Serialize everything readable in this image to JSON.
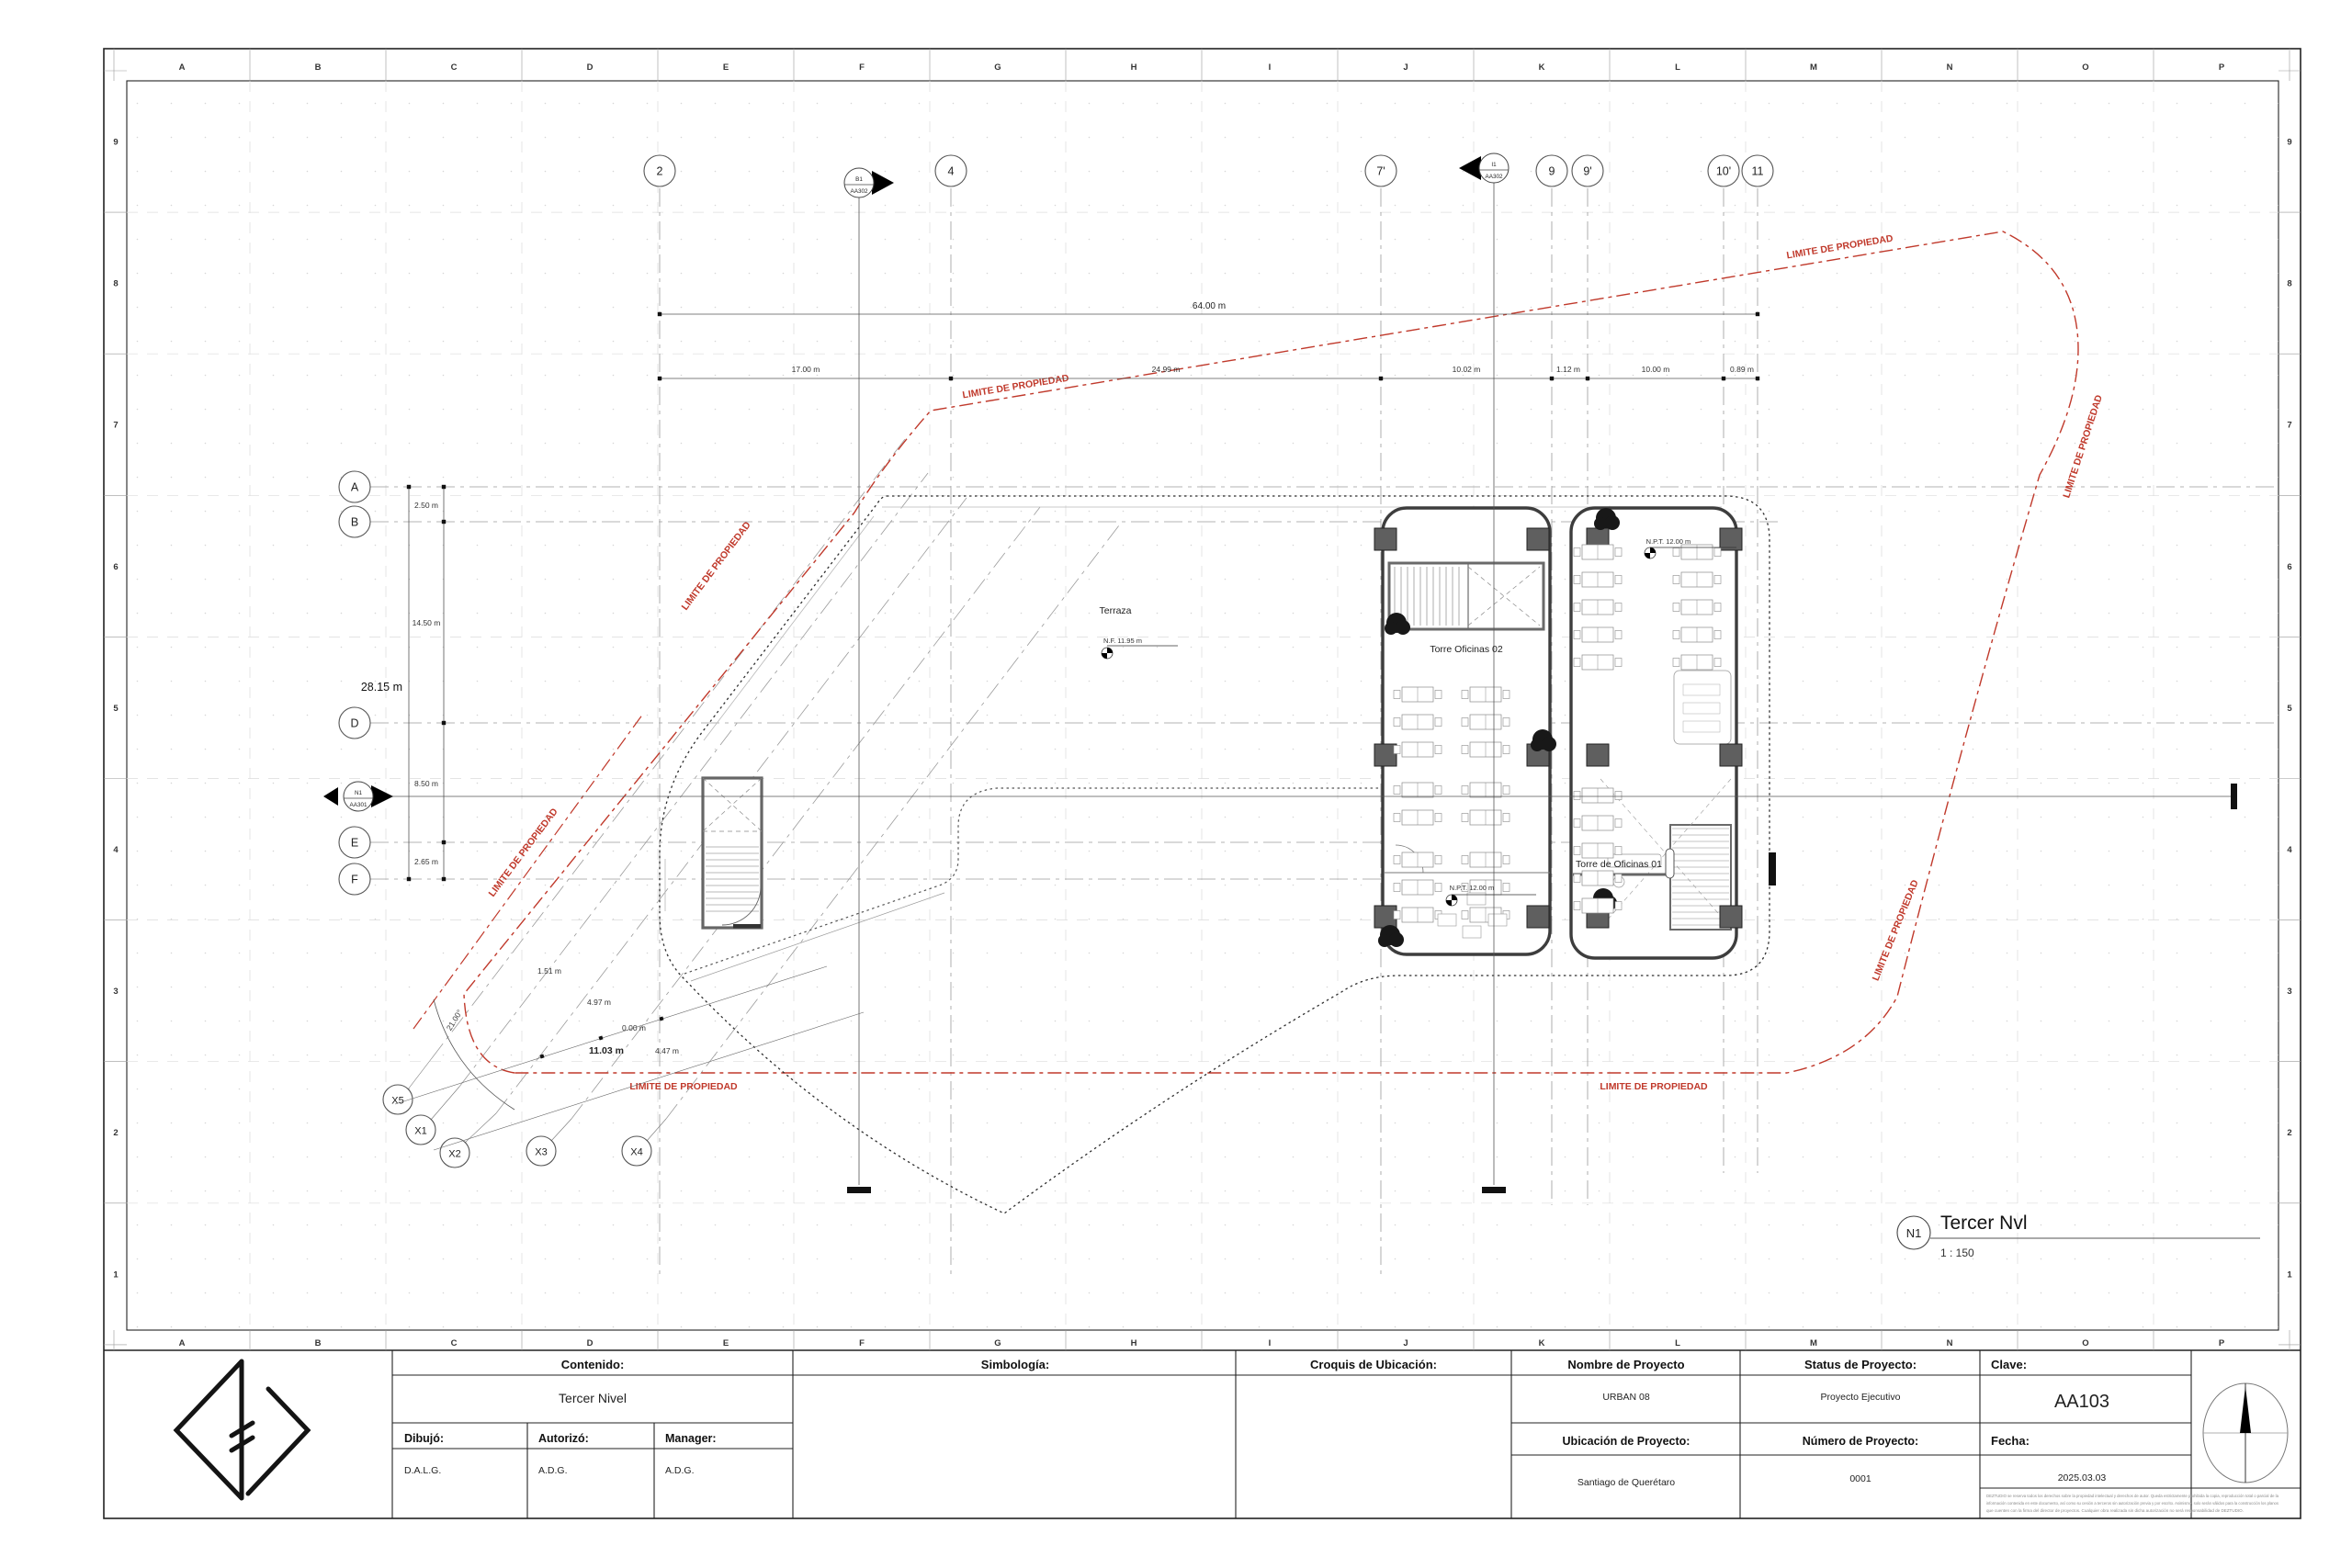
{
  "colors": {
    "red": "#c0392b",
    "column": "#5f5f5f",
    "line": "#3a3a3a",
    "grid": "#9b9b9b"
  },
  "margins": {
    "col_labels": [
      "A",
      "B",
      "C",
      "D",
      "E",
      "F",
      "G",
      "H",
      "I",
      "J",
      "K",
      "L",
      "M",
      "N",
      "O",
      "P"
    ],
    "row_labels": [
      "9",
      "8",
      "7",
      "6",
      "5",
      "4",
      "3",
      "2",
      "1"
    ]
  },
  "grids": {
    "top": [
      "2",
      "4",
      "7'",
      "9",
      "9'",
      "10'",
      "11"
    ],
    "left": [
      "A",
      "B",
      "D",
      "E",
      "F"
    ],
    "bottom": [
      "X5",
      "X1",
      "X2",
      "X3",
      "X4"
    ]
  },
  "markers": {
    "b1": {
      "top": "B1",
      "bottom": "AA302"
    },
    "i1": {
      "top": "I1",
      "bottom": "AA302"
    },
    "n1": {
      "top": "N1",
      "bottom": "AA301"
    }
  },
  "dims": {
    "overall_top": "64.00 m",
    "top_chain": [
      "17.00 m",
      "24.99 m",
      "10.02 m",
      "1.12 m",
      "10.00 m",
      "0.89 m"
    ],
    "overall_left": "28.15 m",
    "left_chain": [
      "2.50 m",
      "14.50 m",
      "8.50 m",
      "2.65 m"
    ],
    "corner": [
      "1.51 m",
      "4.97 m",
      "0.00 m",
      "11.03 m",
      "4.47 m"
    ],
    "angle": "21.00°"
  },
  "plan": {
    "terraza": "Terraza",
    "terraza_level": "N.F. 11.95 m",
    "tower02": "Torre Oficinas 02",
    "tower01": "Torre de Oficinas 01",
    "npt": "N.P.T. 12.00 m",
    "limite": "LIMITE DE PROPIEDAD"
  },
  "view_title": {
    "bubble": "N1",
    "title": "Tercer Nvl",
    "scale": "1 : 150"
  },
  "title_block": {
    "contenido_label": "Contenido:",
    "contenido": "Tercer Nivel",
    "dibujo_label": "Dibujó:",
    "dibujo": "D.A.L.G.",
    "autorizo_label": "Autorizó:",
    "autorizo": "A.D.G.",
    "manager_label": "Manager:",
    "manager": "A.D.G.",
    "simbologia_label": "Simbología:",
    "croquis_label": "Croquis de Ubicación:",
    "nombre_label": "Nombre de Proyecto",
    "nombre": "URBAN 08",
    "ubicacion_label": "Ubicación de Proyecto:",
    "ubicacion": "Santiago de Querétaro",
    "status_label": "Status de Proyecto:",
    "status": "Proyecto Ejecutivo",
    "numero_label": "Número de Proyecto:",
    "numero": "0001",
    "clave_label": "Clave:",
    "clave": "AA103",
    "fecha_label": "Fecha:",
    "fecha": "2025.03.03",
    "disclaimer": [
      "DEZTUDIO se reserva todos los derechos sobre la propiedad intelectual y derechos de autor. Queda estrictamente prohibida la copia, reproducción total o parcial de la",
      "información contenida en este documento, así como su cesión a terceros sin autorización previa y por escrito. Asimismo, solo serán válidos para la construcción los planos",
      "que cuenten con la firma del director de proyectos. Cualquier obra realizada sin dicha autorización no será responsabilidad de DEZTUDIO."
    ]
  }
}
